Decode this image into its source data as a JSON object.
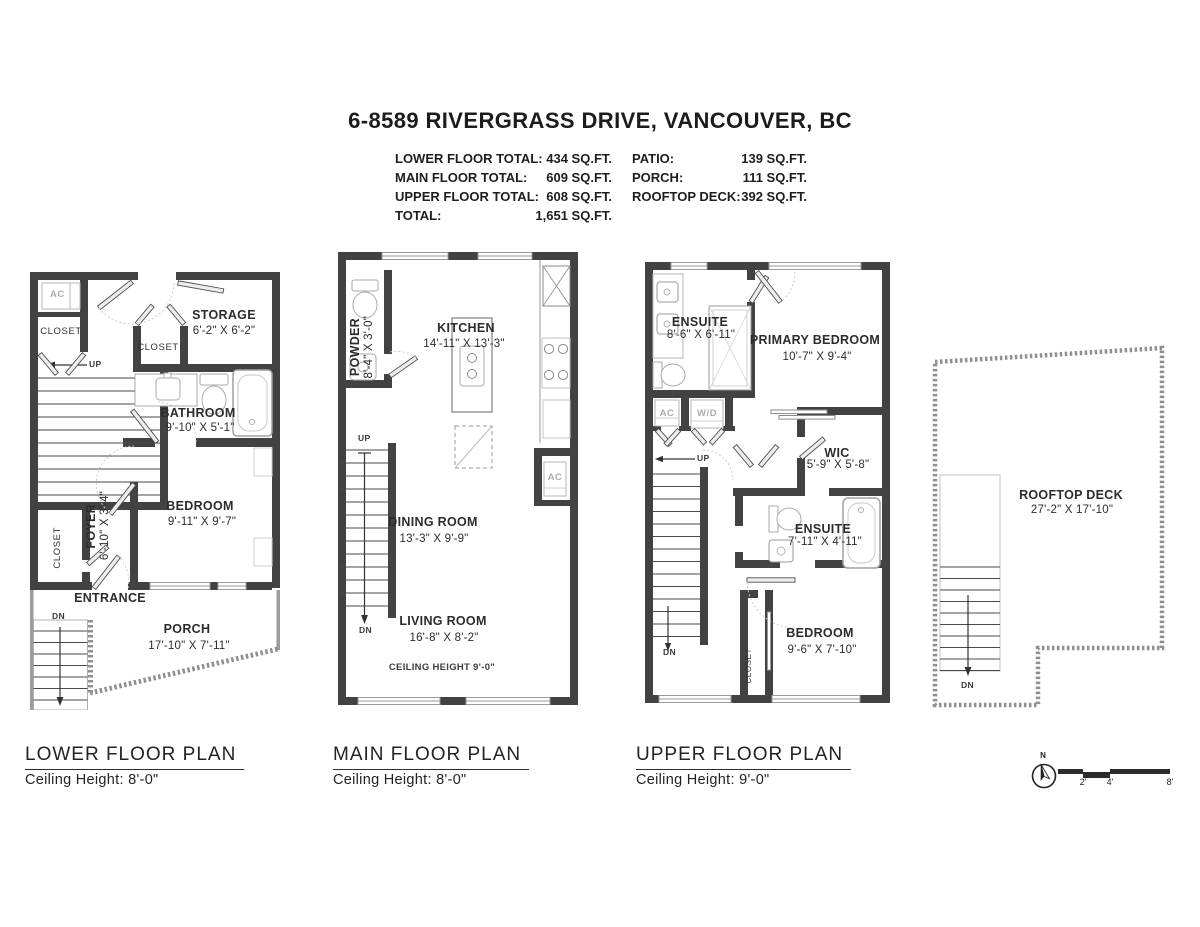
{
  "title": "6-8589 RIVERGRASS DRIVE, VANCOUVER, BC",
  "summary": {
    "rows_left": [
      {
        "label": "LOWER FLOOR TOTAL:",
        "value": "434 SQ.FT."
      },
      {
        "label": "MAIN FLOOR TOTAL:",
        "value": "609 SQ.FT."
      },
      {
        "label": "UPPER FLOOR TOTAL:",
        "value": "608 SQ.FT."
      },
      {
        "label": "TOTAL:",
        "value": "1,651 SQ.FT."
      }
    ],
    "rows_right": [
      {
        "label": "PATIO:",
        "value": "139 SQ.FT."
      },
      {
        "label": "PORCH:",
        "value": "111 SQ.FT."
      },
      {
        "label": "ROOFTOP DECK:",
        "value": "392 SQ.FT."
      }
    ]
  },
  "lower": {
    "footer_title": "LOWER FLOOR PLAN",
    "footer_sub": "Ceiling Height: 8'-0\"",
    "ac": "AC",
    "closet_top": "CLOSET",
    "closet_mid": "CLOSET",
    "closet_bottom": "CLOSET",
    "storage_name": "STORAGE",
    "storage_dims": "6'-2\" X 6'-2\"",
    "bathroom_name": "BATHROOM",
    "bathroom_dims": "9'-10\" X 5'-1\"",
    "foyer_name": "FOYER",
    "foyer_dims": "6'-10\" X 3'-4\"",
    "bedroom_name": "BEDROOM",
    "bedroom_dims": "9'-11\" X 9'-7\"",
    "entrance": "ENTRANCE",
    "porch_name": "PORCH",
    "porch_dims": "17'-10\" X 7'-11\"",
    "up": "UP",
    "dn": "DN"
  },
  "main": {
    "footer_title": "MAIN FLOOR PLAN",
    "footer_sub": "Ceiling Height: 8'-0\"",
    "powder_name": "POWDER",
    "powder_dims": "8'-4\" X 3'-0\"",
    "kitchen_name": "KITCHEN",
    "kitchen_dims": "14'-11\" X 13'-3\"",
    "dining_name": "DINING ROOM",
    "dining_dims": "13'-3\" X 9'-9\"",
    "living_name": "LIVING ROOM",
    "living_dims": "16'-8\" X 8'-2\"",
    "ceiling_note": "CEILING HEIGHT 9'-0\"",
    "ac": "AC",
    "up": "UP",
    "dn": "DN"
  },
  "upper": {
    "footer_title": "UPPER FLOOR PLAN",
    "footer_sub": "Ceiling Height: 9'-0\"",
    "ensuite1_name": "ENSUITE",
    "ensuite1_dims": "8'-6\" X 6'-11\"",
    "primary_name": "PRIMARY BEDROOM",
    "primary_dims": "10'-7\" X 9'-4\"",
    "wic_name": "WIC",
    "wic_dims": "5'-9\" X 5'-8\"",
    "ensuite2_name": "ENSUITE",
    "ensuite2_dims": "7'-11\" X 4'-11\"",
    "bedroom_name": "BEDROOM",
    "bedroom_dims": "9'-6\" X 7'-10\"",
    "closet": "CLOSET",
    "ac": "AC",
    "wd": "W/D",
    "up": "UP",
    "dn": "DN"
  },
  "rooftop": {
    "name": "ROOFTOP DECK",
    "dims": "27'-2\" X 17'-10\"",
    "dn": "DN"
  },
  "compass": {
    "n": "N"
  },
  "scale": {
    "ticks": [
      "2'",
      "4'",
      "8'"
    ]
  }
}
